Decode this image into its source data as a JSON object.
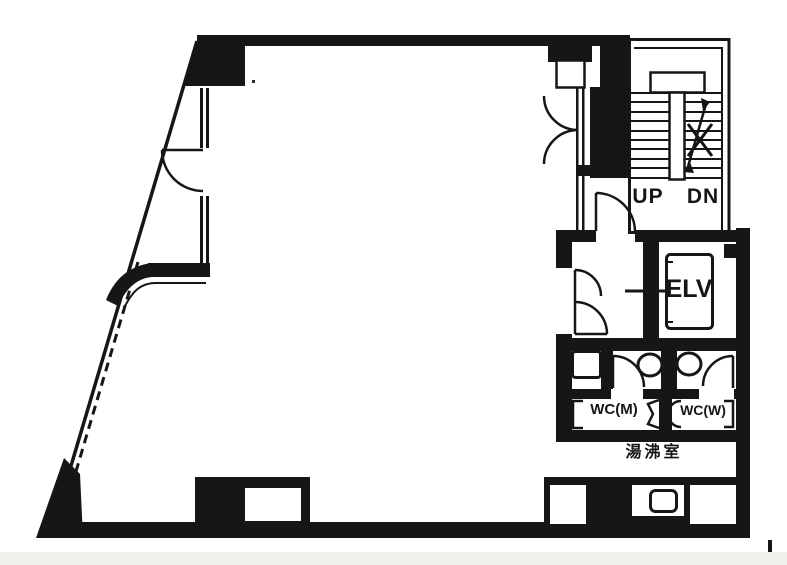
{
  "plan": {
    "labels": {
      "up": "UP",
      "down": "DN",
      "elevator": "ELV",
      "wc_men": "WC(M)",
      "wc_women": "WC(W)",
      "kitchenette": "湯沸室"
    },
    "colors": {
      "ink": "#161616",
      "paper": "#ffffff"
    }
  }
}
